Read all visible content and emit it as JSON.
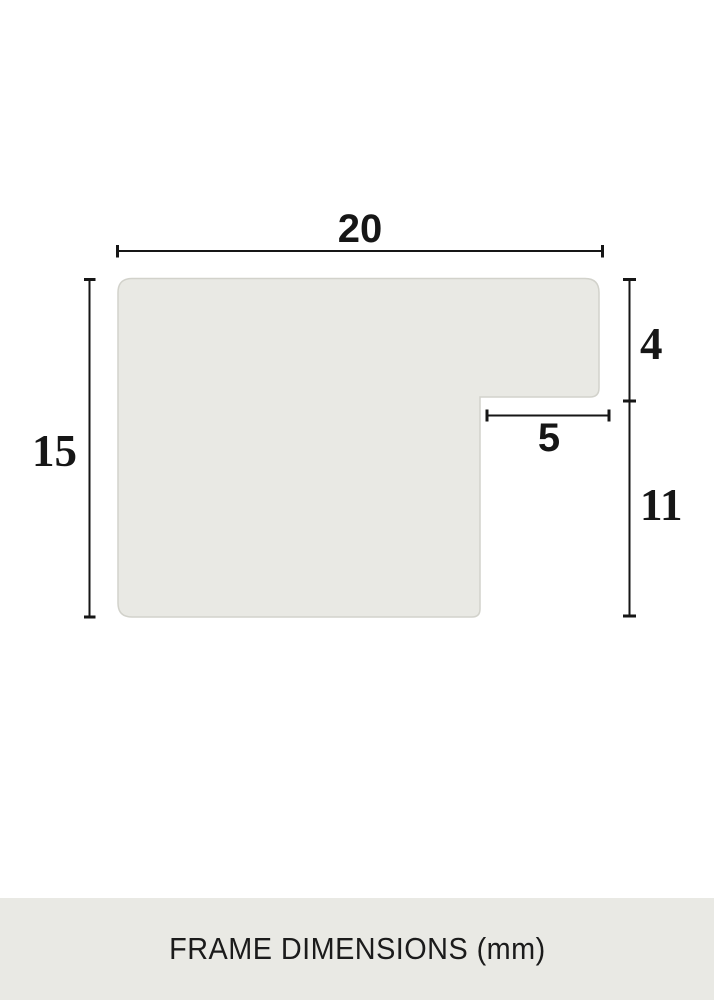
{
  "title": "Frame profile cross-section diagram",
  "colors": {
    "background": "#ffffff",
    "shape_fill": "#e9e9e4",
    "shape_stroke": "#d2d2cb",
    "dimension_line": "#161616",
    "label_text": "#161616",
    "footer_background": "#e9e9e4"
  },
  "diagram": {
    "dimensions": {
      "top_width": "20",
      "left_height": "15",
      "right_upper_height": "4",
      "notch_width": "5",
      "right_lower_height": "11"
    }
  },
  "footer": {
    "caption": "FRAME DIMENSIONS (mm)"
  }
}
